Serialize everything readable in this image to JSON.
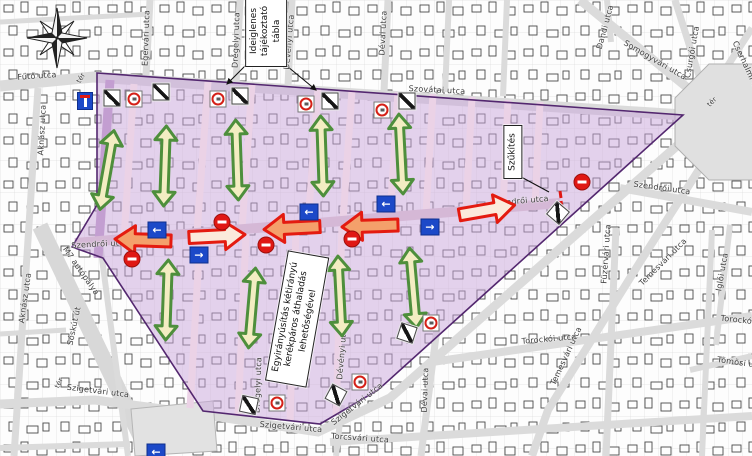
{
  "canvas": {
    "width": 752,
    "height": 456
  },
  "colors": {
    "zone_fill": "#C9A5DB",
    "zone_border": "#53276F",
    "inner_street_pink": "#EBD2E6",
    "main_street_pink": "#D5B8D6",
    "dark_purple_street": "#C39ED1",
    "road_gray": "#DBDBDB",
    "green_arrow_fill": "#F3EDC2",
    "green_arrow_border": "#4E8F3C",
    "orange_arrow_fill": "#F4A06B",
    "cream_arrow_fill": "#FBEADB",
    "street_arrow_border": "#E41B10",
    "oneway_blue": "#1C49C8",
    "noentry_red": "#E01814"
  },
  "callouts": {
    "temp_board": {
      "lines": [
        "Ideiglenes",
        "tájékoztató",
        "tábla"
      ]
    },
    "narrowing": {
      "text": "Szűkítés"
    },
    "oneway_note": {
      "lines": [
        "Egyirányúsítás kétirányú",
        "kerékpáros áthaladás",
        "lehetőségével"
      ]
    }
  },
  "street_labels": [
    {
      "text": "Fűtő utca",
      "x": 37,
      "y": 76,
      "rot": -4,
      "size": "normal"
    },
    {
      "text": "tér",
      "x": 81,
      "y": 78,
      "rot": -60,
      "size": "small"
    },
    {
      "text": "Aknász utca",
      "x": 42,
      "y": 130,
      "rot": -87,
      "size": "normal"
    },
    {
      "text": "Egervári utca",
      "x": 146,
      "y": 38,
      "rot": -88,
      "size": "normal"
    },
    {
      "text": "Drégelyi utca",
      "x": 236,
      "y": 40,
      "rot": -88,
      "size": "normal"
    },
    {
      "text": "Dévényi utca",
      "x": 289,
      "y": 42,
      "rot": -85,
      "size": "normal"
    },
    {
      "text": "Dévai utca",
      "x": 383,
      "y": 33,
      "rot": -87,
      "size": "normal"
    },
    {
      "text": "Dandi utca",
      "x": 605,
      "y": 27,
      "rot": -75,
      "size": "normal"
    },
    {
      "text": "Somogyvári utca",
      "x": 655,
      "y": 60,
      "rot": 30,
      "size": "normal"
    },
    {
      "text": "Csurgói utca",
      "x": 692,
      "y": 52,
      "rot": -80,
      "size": "normal"
    },
    {
      "text": "Cserhalmi utca",
      "x": 748,
      "y": 70,
      "rot": 65,
      "size": "normal"
    },
    {
      "text": "Szovátai utca",
      "x": 437,
      "y": 90,
      "rot": 3,
      "size": "normal"
    },
    {
      "text": "Szendrői utca",
      "x": 100,
      "y": 244,
      "rot": -3,
      "size": "normal"
    },
    {
      "text": "Szendrői utca",
      "x": 520,
      "y": 201,
      "rot": -5,
      "size": "normal"
    },
    {
      "text": "Szendrői utca",
      "x": 662,
      "y": 188,
      "rot": 8,
      "size": "normal"
    },
    {
      "text": "tér",
      "x": 712,
      "y": 102,
      "rot": -45,
      "size": "small"
    },
    {
      "text": "Füzérvári utca",
      "x": 606,
      "y": 254,
      "rot": -86,
      "size": "normal"
    },
    {
      "text": "Temesvári utca",
      "x": 663,
      "y": 262,
      "rot": -45,
      "size": "normal"
    },
    {
      "text": "Temesvári utca",
      "x": 566,
      "y": 356,
      "rot": -65,
      "size": "normal"
    },
    {
      "text": "Iglói utca",
      "x": 722,
      "y": 272,
      "rot": -80,
      "size": "normal"
    },
    {
      "text": "Torockói utca",
      "x": 549,
      "y": 339,
      "rot": -5,
      "size": "normal"
    },
    {
      "text": "Torockói utca",
      "x": 748,
      "y": 321,
      "rot": 6,
      "size": "normal"
    },
    {
      "text": "Tömösi utca",
      "x": 742,
      "y": 363,
      "rot": 8,
      "size": "normal"
    },
    {
      "text": "M7 autópálya",
      "x": 81,
      "y": 271,
      "rot": 55,
      "size": "normal"
    },
    {
      "text": "Sóskút út",
      "x": 74,
      "y": 326,
      "rot": -78,
      "size": "normal"
    },
    {
      "text": "Aknász utca",
      "x": 25,
      "y": 298,
      "rot": -82,
      "size": "normal"
    },
    {
      "text": "tér",
      "x": 59,
      "y": 383,
      "rot": -65,
      "size": "small"
    },
    {
      "text": "Szigetvári utca",
      "x": 98,
      "y": 391,
      "rot": 7,
      "size": "normal"
    },
    {
      "text": "Szigetvári utca",
      "x": 291,
      "y": 427,
      "rot": 5,
      "size": "normal"
    },
    {
      "text": "Szigetvári utca",
      "x": 357,
      "y": 404,
      "rot": -38,
      "size": "normal"
    },
    {
      "text": "Torcsvári utca",
      "x": 360,
      "y": 438,
      "rot": 4,
      "size": "normal"
    },
    {
      "text": "Drégelyi utca",
      "x": 258,
      "y": 385,
      "rot": -88,
      "size": "normal"
    },
    {
      "text": "Dévényi utca",
      "x": 342,
      "y": 352,
      "rot": -85,
      "size": "normal"
    },
    {
      "text": "Dévai utca",
      "x": 425,
      "y": 390,
      "rot": -88,
      "size": "normal"
    }
  ],
  "signs": {
    "dead_end": [
      {
        "x": 85,
        "y": 101
      }
    ],
    "one_way": [
      {
        "x": 157,
        "y": 230,
        "dir": "left"
      },
      {
        "x": 199,
        "y": 255,
        "dir": "right"
      },
      {
        "x": 309,
        "y": 212,
        "dir": "left"
      },
      {
        "x": 386,
        "y": 204,
        "dir": "left"
      },
      {
        "x": 430,
        "y": 227,
        "dir": "right"
      },
      {
        "x": 156,
        "y": 452,
        "dir": "left"
      }
    ],
    "no_entry": [
      {
        "x": 132,
        "y": 259
      },
      {
        "x": 222,
        "y": 222
      },
      {
        "x": 266,
        "y": 245
      },
      {
        "x": 352,
        "y": 239
      },
      {
        "x": 582,
        "y": 182
      }
    ],
    "prohibition": [
      {
        "x": 134,
        "y": 99
      },
      {
        "x": 218,
        "y": 99
      },
      {
        "x": 306,
        "y": 104
      },
      {
        "x": 382,
        "y": 110
      },
      {
        "x": 277,
        "y": 403
      },
      {
        "x": 360,
        "y": 382
      },
      {
        "x": 431,
        "y": 323
      }
    ],
    "diagonal_stripe": [
      {
        "x": 112,
        "y": 98,
        "rot": 0
      },
      {
        "x": 161,
        "y": 92,
        "rot": 0
      },
      {
        "x": 240,
        "y": 96,
        "rot": 0
      },
      {
        "x": 330,
        "y": 101,
        "rot": 0
      },
      {
        "x": 407,
        "y": 101,
        "rot": 0
      },
      {
        "x": 558,
        "y": 213,
        "rot": 40
      },
      {
        "x": 249,
        "y": 405,
        "rot": 12
      },
      {
        "x": 336,
        "y": 395,
        "rot": 28
      },
      {
        "x": 407,
        "y": 333,
        "rot": 18
      }
    ]
  },
  "arrows": {
    "green_double": [
      {
        "x": 107,
        "y": 170,
        "rot": 10
      },
      {
        "x": 165,
        "y": 166,
        "rot": 2
      },
      {
        "x": 237,
        "y": 160,
        "rot": -2
      },
      {
        "x": 322,
        "y": 156,
        "rot": -2
      },
      {
        "x": 401,
        "y": 154,
        "rot": -3
      },
      {
        "x": 167,
        "y": 300,
        "rot": 2
      },
      {
        "x": 252,
        "y": 308,
        "rot": 5
      },
      {
        "x": 340,
        "y": 296,
        "rot": -3
      },
      {
        "x": 413,
        "y": 288,
        "rot": -5
      }
    ],
    "street_arrows": [
      {
        "x": 143,
        "y": 240,
        "dir": "left",
        "fill": "orange",
        "rot": 2
      },
      {
        "x": 217,
        "y": 236,
        "dir": "right",
        "fill": "cream",
        "rot": -3
      },
      {
        "x": 292,
        "y": 228,
        "dir": "left",
        "fill": "orange",
        "rot": -3
      },
      {
        "x": 370,
        "y": 226,
        "dir": "left",
        "fill": "orange",
        "rot": -2
      },
      {
        "x": 487,
        "y": 210,
        "dir": "right",
        "fill": "cream",
        "rot": -10
      }
    ]
  }
}
